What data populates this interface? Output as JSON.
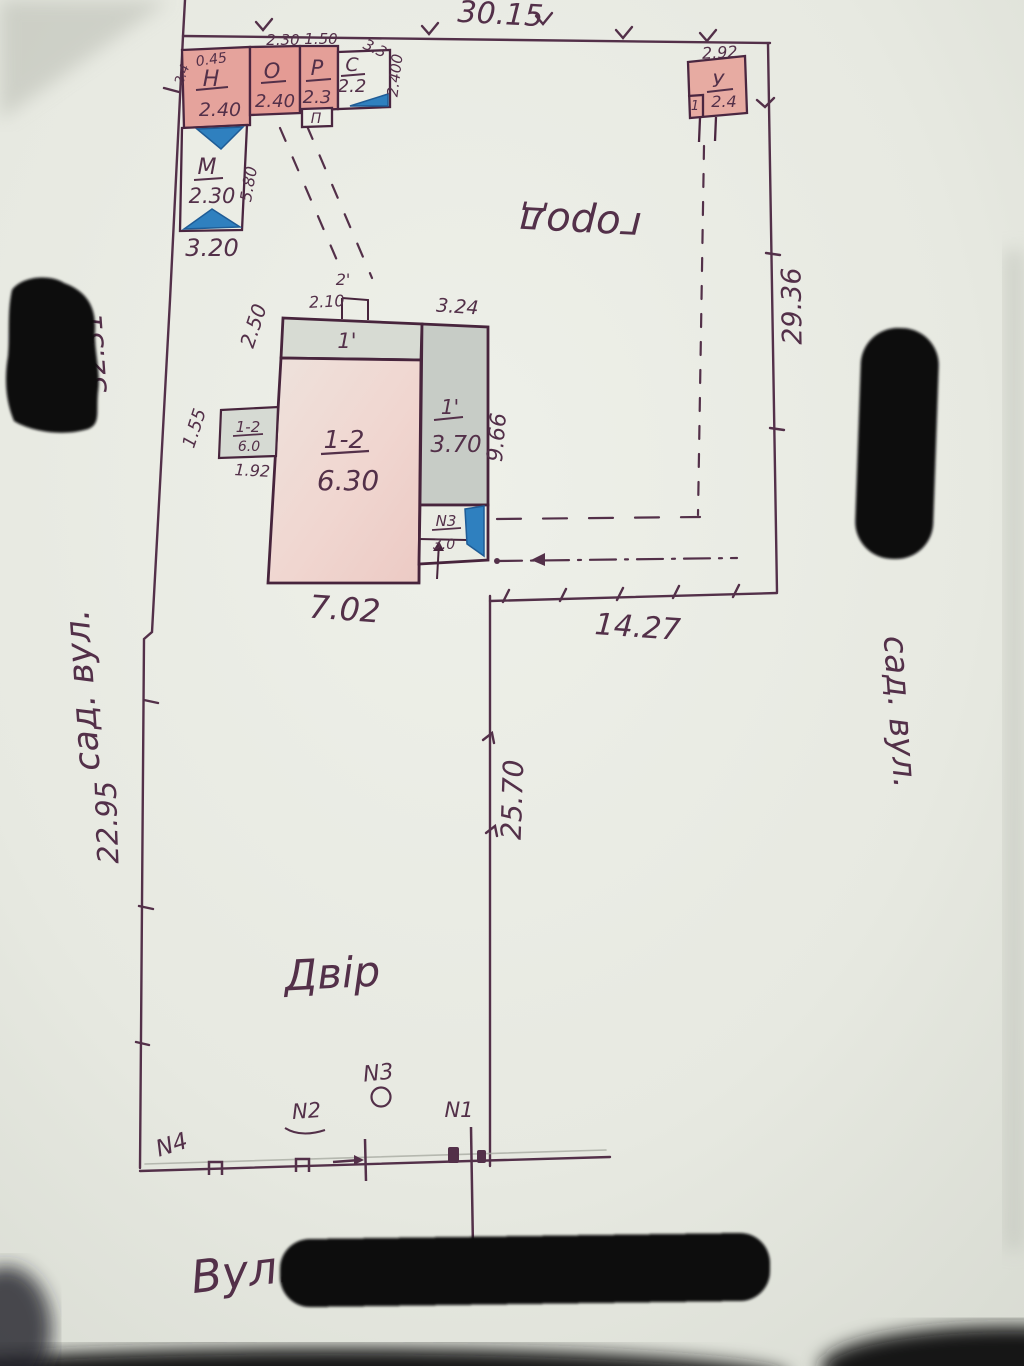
{
  "plan": {
    "boundary": {
      "top": "30.15",
      "left_upper": "32.31",
      "left_lower": "22.95",
      "right": "29.36",
      "middle": "25.70",
      "garden_bottom": "14.27"
    },
    "areas": {
      "garden": "город",
      "yard": "Двір"
    },
    "streets": {
      "bottom": "Вул.",
      "left": "сад. вул.",
      "right": "сад. вул."
    },
    "outbuildings": {
      "n": {
        "label": "Н",
        "value": "2.40",
        "top": "0.45",
        "side": "2.4"
      },
      "o": {
        "label": "О",
        "value": "2.40",
        "top": "2.30"
      },
      "p": {
        "label": "Р",
        "value": "2.3",
        "top": "1.50",
        "porch": "П"
      },
      "s": {
        "label": "С",
        "value": "2.2",
        "diag": "3.3",
        "side": "2.400"
      },
      "m": {
        "label": "М",
        "value": "2.30",
        "side": "5.80",
        "bottom": "3.20"
      },
      "u": {
        "label": "У",
        "value": "2.4",
        "top": "2.92",
        "corner": "1"
      }
    },
    "house": {
      "veranda_label": "1'",
      "veranda_left": "2.50",
      "porch_label": "2'",
      "porch_width": "2.10",
      "room_label": "1-2",
      "room_area": "6.30",
      "wing_label": "1'",
      "wing_area": "3.70",
      "wing_top": "3.24",
      "annex_label": "N3",
      "annex_value": "3.0",
      "side_label": "1-2",
      "side_value": "6.0",
      "side_height": "1.55",
      "side_width": "1.92",
      "width": "7.02",
      "height": "9.66"
    },
    "points": {
      "n1": "N1",
      "n2": "N2",
      "n3": "N3",
      "n4": "N4"
    },
    "colors": {
      "ink": "#533049",
      "pink": "#e7a29b",
      "blue": "#2f80bf",
      "paper": "#e8eae2",
      "redaction": "#0b0a10"
    }
  }
}
